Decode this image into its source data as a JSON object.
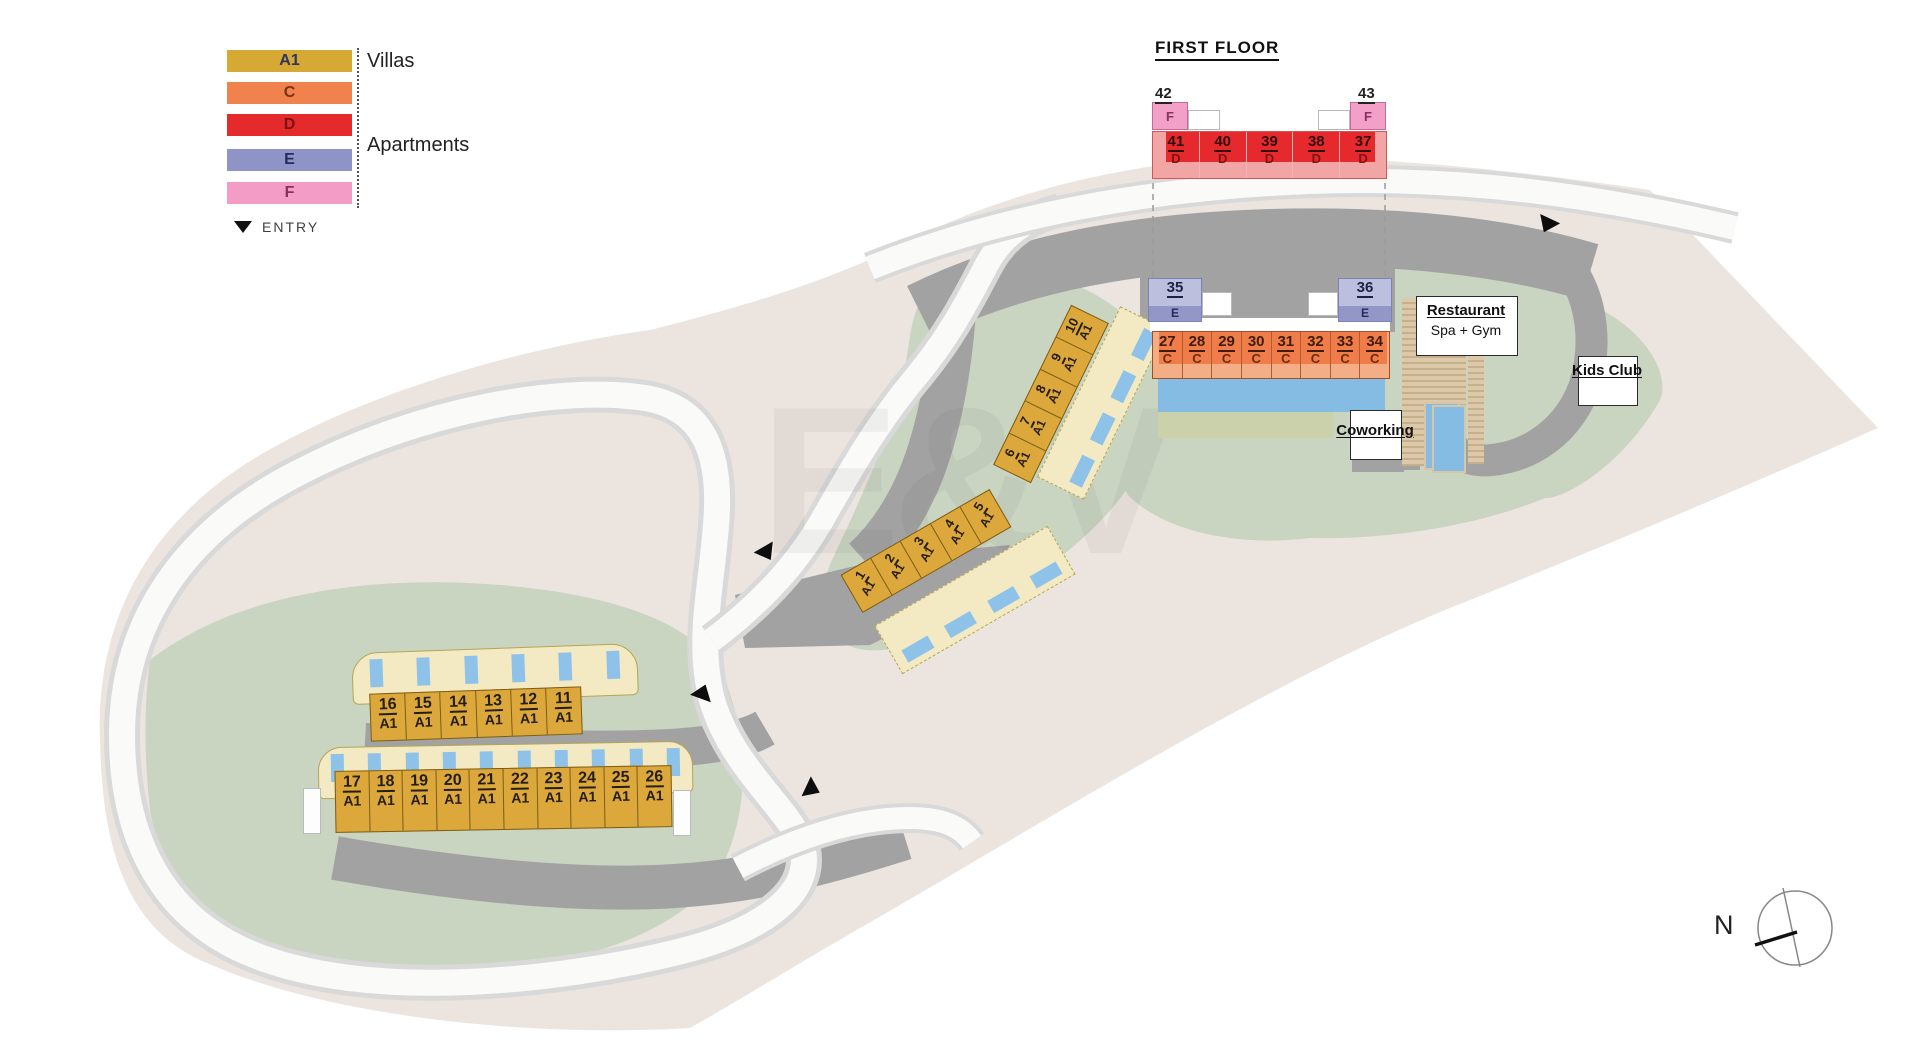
{
  "legend": {
    "items": [
      {
        "code": "A1",
        "color": "#D6A834"
      },
      {
        "code": "C",
        "color": "#F0824E"
      },
      {
        "code": "D",
        "color": "#E52A2B"
      },
      {
        "code": "E",
        "color": "#8F94C6"
      },
      {
        "code": "F",
        "color": "#F29CC6"
      }
    ],
    "villas_label": "Villas",
    "apartments_label": "Apartments",
    "entry_label": "ENTRY"
  },
  "first_floor": {
    "title": "FIRST FLOOR",
    "f_units": [
      {
        "number": "42",
        "type": "F"
      },
      {
        "number": "43",
        "type": "F"
      }
    ],
    "d_units": [
      {
        "number": "41",
        "type": "D"
      },
      {
        "number": "40",
        "type": "D"
      },
      {
        "number": "39",
        "type": "D"
      },
      {
        "number": "38",
        "type": "D"
      },
      {
        "number": "37",
        "type": "D"
      }
    ]
  },
  "ground_floor": {
    "e_units": [
      {
        "number": "35",
        "type": "E"
      },
      {
        "number": "36",
        "type": "E"
      }
    ],
    "c_units": [
      {
        "number": "27",
        "type": "C"
      },
      {
        "number": "28",
        "type": "C"
      },
      {
        "number": "29",
        "type": "C"
      },
      {
        "number": "30",
        "type": "C"
      },
      {
        "number": "31",
        "type": "C"
      },
      {
        "number": "32",
        "type": "C"
      },
      {
        "number": "33",
        "type": "C"
      },
      {
        "number": "34",
        "type": "C"
      }
    ]
  },
  "villas": {
    "north_row": [
      {
        "number": "16",
        "type": "A1"
      },
      {
        "number": "15",
        "type": "A1"
      },
      {
        "number": "14",
        "type": "A1"
      },
      {
        "number": "13",
        "type": "A1"
      },
      {
        "number": "12",
        "type": "A1"
      },
      {
        "number": "11",
        "type": "A1"
      }
    ],
    "south_row": [
      {
        "number": "17",
        "type": "A1"
      },
      {
        "number": "18",
        "type": "A1"
      },
      {
        "number": "19",
        "type": "A1"
      },
      {
        "number": "20",
        "type": "A1"
      },
      {
        "number": "21",
        "type": "A1"
      },
      {
        "number": "22",
        "type": "A1"
      },
      {
        "number": "23",
        "type": "A1"
      },
      {
        "number": "24",
        "type": "A1"
      },
      {
        "number": "25",
        "type": "A1"
      },
      {
        "number": "26",
        "type": "A1"
      }
    ],
    "lower_strip": [
      {
        "number": "1",
        "type": "A1"
      },
      {
        "number": "2",
        "type": "A1"
      },
      {
        "number": "3",
        "type": "A1"
      },
      {
        "number": "4",
        "type": "A1"
      },
      {
        "number": "5",
        "type": "A1"
      }
    ],
    "upper_strip": [
      {
        "number": "6",
        "type": "A1"
      },
      {
        "number": "7",
        "type": "A1"
      },
      {
        "number": "8",
        "type": "A1"
      },
      {
        "number": "9",
        "type": "A1"
      },
      {
        "number": "10",
        "type": "A1"
      }
    ]
  },
  "amenities": {
    "restaurant": "Restaurant",
    "spa_gym": "Spa + Gym",
    "coworking": "Coworking",
    "kids_club": "Kids Club"
  },
  "compass": {
    "north_label": "N"
  },
  "watermark": "E&V",
  "colors": {
    "villa": "#DCA83C",
    "apartment_c": "#EF7C49",
    "apartment_d": "#E6292C",
    "apartment_e": "#9297C8",
    "apartment_f": "#F2A0C8",
    "pool": "#85BCE3",
    "green": "#C9D4C1",
    "road_dark": "#A2A2A2",
    "site": "#ECE5DF"
  }
}
